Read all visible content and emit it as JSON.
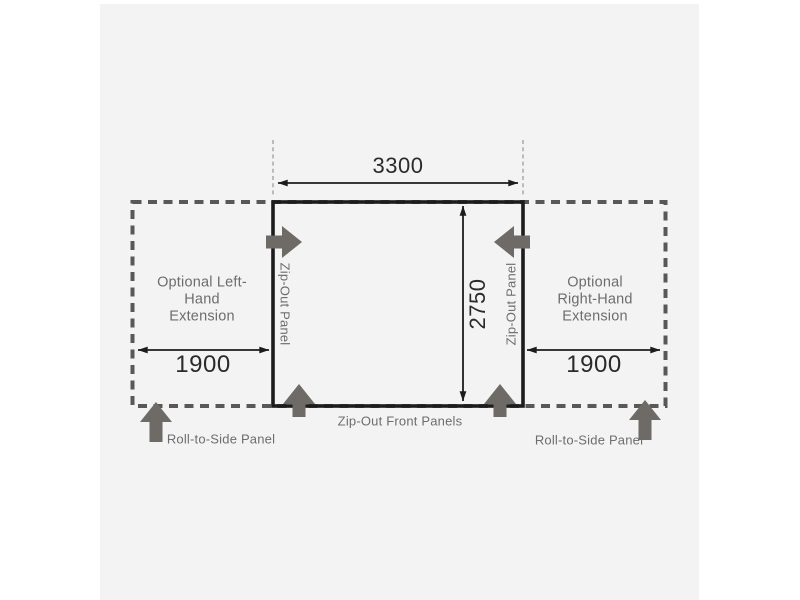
{
  "canvas": {
    "colors": {
      "page_background": "#ffffff",
      "panel_background": "#f3f3f3",
      "outline_black": "#1c1c1c",
      "dashed_gray": "#5a5856",
      "block_arrow_gray": "#6e6a66",
      "label_gray": "#6d6d6d",
      "dimension_text": "#2a2a2a"
    }
  },
  "diagram": {
    "type": "awning-floorplan-dimension-diagram",
    "dimensions": {
      "front_width": "3300",
      "depth": "2750",
      "left_extension_width": "1900",
      "right_extension_width": "1900"
    },
    "labels": {
      "left_extension": "Optional Left-Hand Extension",
      "right_extension": "Optional Right-Hand Extension",
      "left_zip_panel": "Zip-Out Panel",
      "right_zip_panel": "Zip-Out Panel",
      "front_zip_panels": "Zip-Out Front Panels",
      "left_roll_panel": "Roll-to-Side Panel",
      "right_roll_panel": "Roll-to-Side Panel"
    }
  }
}
